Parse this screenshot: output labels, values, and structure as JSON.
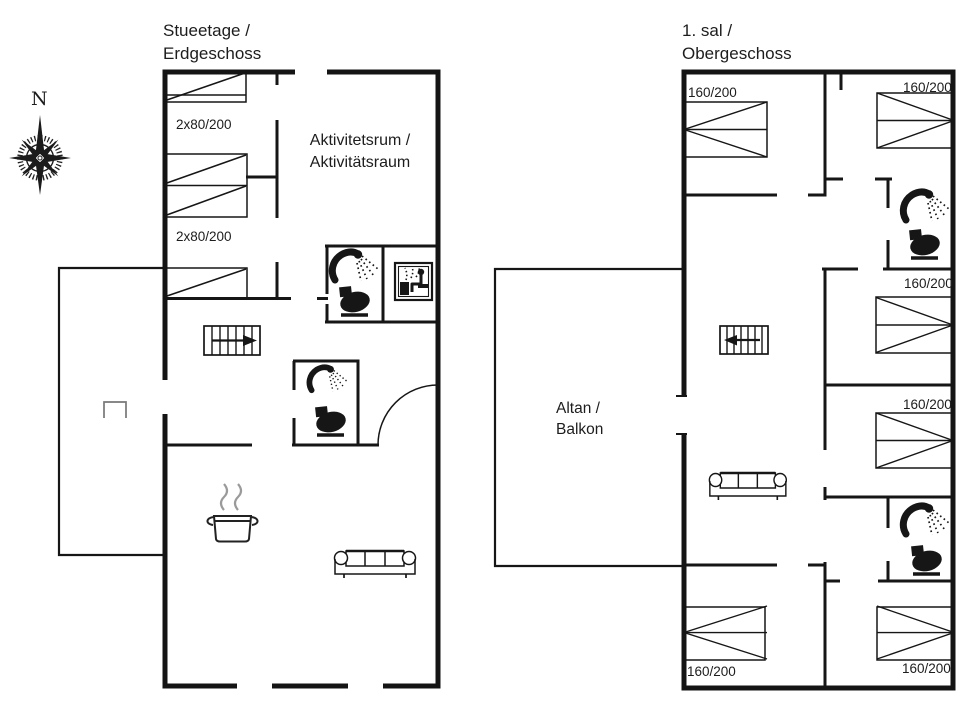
{
  "compass": {
    "north_label": "N"
  },
  "ground_floor": {
    "title": [
      "Stueetage /",
      "Erdgeschoss"
    ],
    "room_label": [
      "Aktivitetsrum /",
      "Aktivitätsraum"
    ],
    "bed_labels": [
      "2x80/200",
      "2x80/200"
    ],
    "icons": [
      "bunk-bed",
      "stairs",
      "shower",
      "toilet",
      "sauna",
      "stove-pot",
      "sofa",
      "door-arc",
      "terrace-grill"
    ]
  },
  "upper_floor": {
    "title": [
      "1. sal /",
      "Obergeschoss"
    ],
    "balcony_label": [
      "Altan /",
      "Balkon"
    ],
    "bed_labels": [
      "160/200",
      "160/200",
      "160/200",
      "160/200",
      "160/200",
      "160/200"
    ],
    "icons": [
      "double-bed",
      "stairs",
      "shower",
      "toilet",
      "sofa"
    ]
  },
  "colors": {
    "line": "#161616",
    "steam": "#9a9a9a",
    "grill": "#777777"
  }
}
